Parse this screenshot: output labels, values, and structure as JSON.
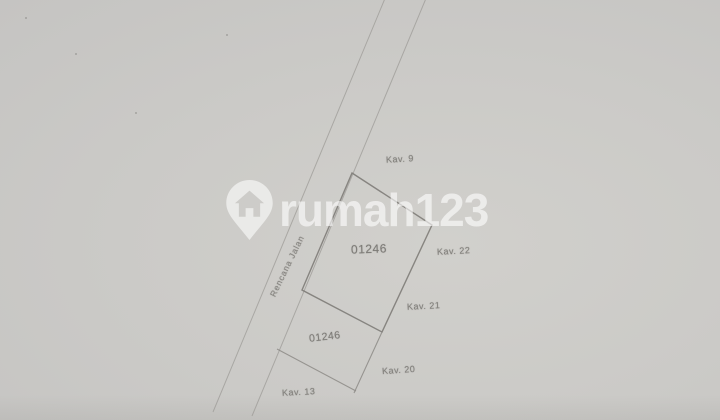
{
  "watermark": {
    "brand": "rumah123",
    "icon": "location-pin-house-icon",
    "color": "#ffffff"
  },
  "plan": {
    "plot_number": "01246",
    "plot_number_secondary": "01246",
    "road_label": "Rencana Jalan",
    "parcel_labels": [
      {
        "id": "kav-9",
        "text": "Kav. 9"
      },
      {
        "id": "kav-22",
        "text": "Kav. 22"
      },
      {
        "id": "kav-21",
        "text": "Kav. 21"
      },
      {
        "id": "kav-20",
        "text": "Kav. 20"
      },
      {
        "id": "kav-13",
        "text": "Kav. 13"
      }
    ]
  },
  "colors": {
    "paper_background": "#cac9c6",
    "boundary_line": "#7e7c78",
    "road_line": "#9d9b97",
    "label_text": "#82807c"
  }
}
